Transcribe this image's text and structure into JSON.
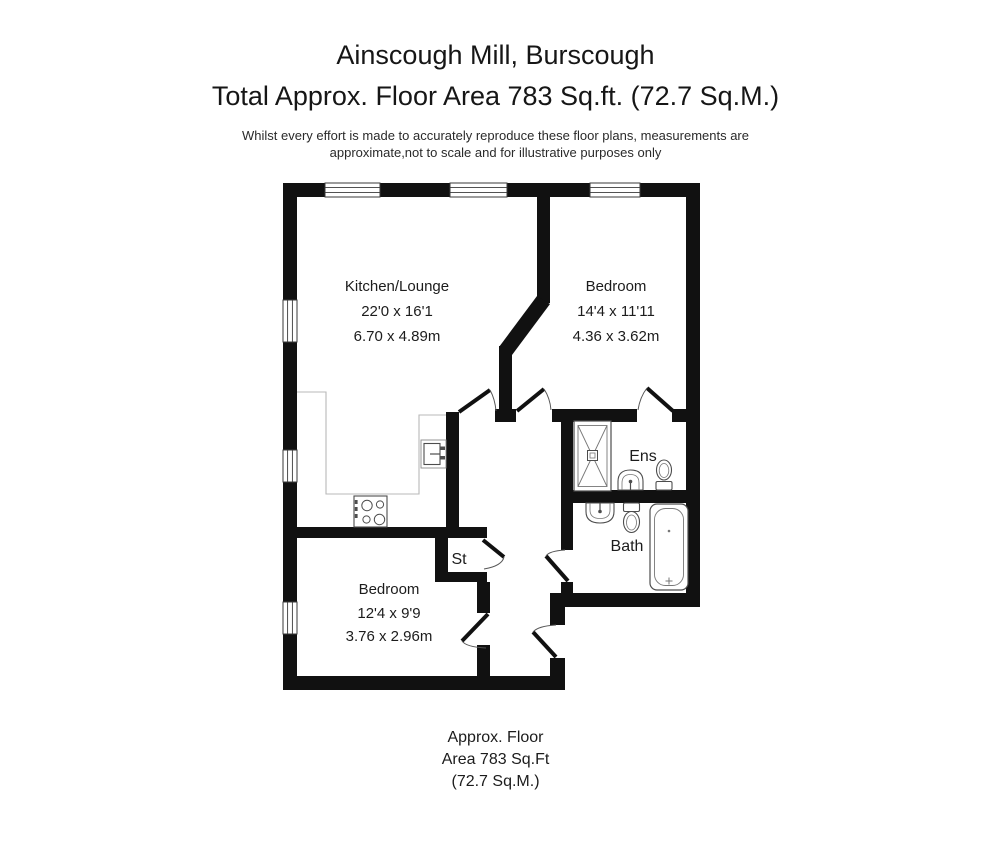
{
  "header": {
    "title": "Ainscough Mill, Burscough",
    "subtitle": "Total Approx. Floor Area 783 Sq.ft. (72.7 Sq.M.)",
    "disclaimer_line1": "Whilst every effort is made to accurately reproduce these floor plans, measurements are",
    "disclaimer_line2": "approximate,not to scale and for illustrative purposes only"
  },
  "plan": {
    "rooms": [
      {
        "name": "Kitchen/Lounge",
        "dims_imperial": "22'0 x 16'1",
        "dims_metric": "6.70 x 4.89m"
      },
      {
        "name": "Bedroom",
        "dims_imperial": "14'4 x 11'11",
        "dims_metric": "4.36 x 3.62m"
      },
      {
        "name": "Bedroom",
        "dims_imperial": "12'4 x 9'9",
        "dims_metric": "3.76 x 2.96m"
      },
      {
        "name": "Ens"
      },
      {
        "name": "Bath"
      },
      {
        "name": "St"
      }
    ]
  },
  "footer": {
    "line1": "Approx. Floor",
    "line2": "Area 783 Sq.Ft",
    "line3": "(72.7 Sq.M.)"
  },
  "colors": {
    "wall": "#111111",
    "fixture_outline": "#4d4d4d",
    "counter_line": "#b8b8b8",
    "text": "#1c1c1c",
    "background": "#ffffff"
  }
}
